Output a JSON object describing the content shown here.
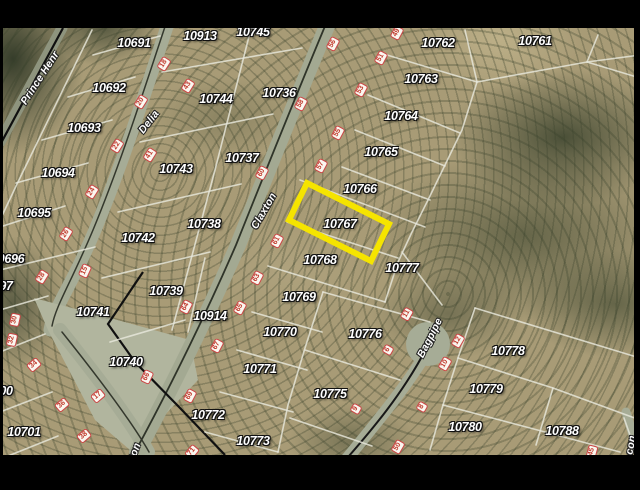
{
  "map": {
    "highlight": {
      "parcel": "10767",
      "color": "#f5e400"
    },
    "marker_color": "#c0392b",
    "road_color": "#a6ac96",
    "parcel_line_color": "#e8e8dc",
    "parcels": [
      {
        "label": "10691",
        "x": 134,
        "y": 43
      },
      {
        "label": "10913",
        "x": 200,
        "y": 36
      },
      {
        "label": "10745",
        "x": 253,
        "y": 32
      },
      {
        "label": "10762",
        "x": 438,
        "y": 43
      },
      {
        "label": "10761",
        "x": 535,
        "y": 41
      },
      {
        "label": "10692",
        "x": 109,
        "y": 88
      },
      {
        "label": "10744",
        "x": 216,
        "y": 99
      },
      {
        "label": "10736",
        "x": 279,
        "y": 93
      },
      {
        "label": "10763",
        "x": 421,
        "y": 79
      },
      {
        "label": "10693",
        "x": 84,
        "y": 128
      },
      {
        "label": "10737",
        "x": 242,
        "y": 158
      },
      {
        "label": "10764",
        "x": 401,
        "y": 116
      },
      {
        "label": "10694",
        "x": 58,
        "y": 173
      },
      {
        "label": "10743",
        "x": 176,
        "y": 169
      },
      {
        "label": "10765",
        "x": 381,
        "y": 152
      },
      {
        "label": "10695",
        "x": 34,
        "y": 213
      },
      {
        "label": "10738",
        "x": 204,
        "y": 224
      },
      {
        "label": "10742",
        "x": 138,
        "y": 238
      },
      {
        "label": "10766",
        "x": 360,
        "y": 189
      },
      {
        "label": "10767",
        "x": 340,
        "y": 224,
        "highlight": true
      },
      {
        "label": "0696",
        "x": 11,
        "y": 259
      },
      {
        "label": "97",
        "x": 6,
        "y": 286
      },
      {
        "label": "10768",
        "x": 320,
        "y": 260
      },
      {
        "label": "10777",
        "x": 402,
        "y": 268
      },
      {
        "label": "10739",
        "x": 166,
        "y": 291
      },
      {
        "label": "10769",
        "x": 299,
        "y": 297
      },
      {
        "label": "10741",
        "x": 93,
        "y": 312
      },
      {
        "label": "10914",
        "x": 210,
        "y": 316
      },
      {
        "label": "10770",
        "x": 280,
        "y": 332
      },
      {
        "label": "10776",
        "x": 365,
        "y": 334
      },
      {
        "label": "10778",
        "x": 508,
        "y": 351
      },
      {
        "label": "10740",
        "x": 126,
        "y": 362
      },
      {
        "label": "10771",
        "x": 260,
        "y": 369
      },
      {
        "label": "10775",
        "x": 330,
        "y": 394
      },
      {
        "label": "00",
        "x": 6,
        "y": 391
      },
      {
        "label": "10779",
        "x": 486,
        "y": 389
      },
      {
        "label": "10772",
        "x": 208,
        "y": 415
      },
      {
        "label": "10780",
        "x": 465,
        "y": 427
      },
      {
        "label": "10788",
        "x": 562,
        "y": 431
      },
      {
        "label": "10701",
        "x": 24,
        "y": 432
      },
      {
        "label": "10773",
        "x": 253,
        "y": 441
      }
    ],
    "streets": [
      {
        "name": "Prince Henr",
        "x": 40,
        "y": 78,
        "rot": -57
      },
      {
        "name": "Delia",
        "x": 149,
        "y": 122,
        "rot": -52
      },
      {
        "name": "Claxton",
        "x": 264,
        "y": 211,
        "rot": -60
      },
      {
        "name": "Claxton",
        "x": 131,
        "y": 462,
        "rot": -70
      },
      {
        "name": "Bagpipe",
        "x": 430,
        "y": 338,
        "rot": -63
      },
      {
        "name": "con",
        "x": 631,
        "y": 445,
        "rot": -80
      }
    ],
    "address_markers": [
      {
        "n": "18",
        "x": 164,
        "y": 64,
        "rot": -58
      },
      {
        "n": "20",
        "x": 141,
        "y": 102,
        "rot": -58
      },
      {
        "n": "22",
        "x": 117,
        "y": 146,
        "rot": -58
      },
      {
        "n": "24",
        "x": 92,
        "y": 192,
        "rot": -58
      },
      {
        "n": "26",
        "x": 66,
        "y": 234,
        "rot": -58
      },
      {
        "n": "28",
        "x": 42,
        "y": 277,
        "rot": -58
      },
      {
        "n": "30",
        "x": 15,
        "y": 320,
        "rot": -78
      },
      {
        "n": "32",
        "x": 12,
        "y": 340,
        "rot": -78
      },
      {
        "n": "34",
        "x": 34,
        "y": 365,
        "rot": -40
      },
      {
        "n": "36",
        "x": 62,
        "y": 405,
        "rot": -40
      },
      {
        "n": "38",
        "x": 84,
        "y": 436,
        "rot": -40
      },
      {
        "n": "43",
        "x": 188,
        "y": 86,
        "rot": -58
      },
      {
        "n": "41",
        "x": 150,
        "y": 155,
        "rot": -58
      },
      {
        "n": "15",
        "x": 85,
        "y": 271,
        "rot": -65
      },
      {
        "n": "17",
        "x": 98,
        "y": 396,
        "rot": -40
      },
      {
        "n": "56",
        "x": 333,
        "y": 44,
        "rot": -62
      },
      {
        "n": "58",
        "x": 301,
        "y": 104,
        "rot": -62
      },
      {
        "n": "60",
        "x": 262,
        "y": 173,
        "rot": -62
      },
      {
        "n": "64",
        "x": 186,
        "y": 307,
        "rot": -62
      },
      {
        "n": "66",
        "x": 147,
        "y": 377,
        "rot": -65
      },
      {
        "n": "49",
        "x": 397,
        "y": 33,
        "rot": -62
      },
      {
        "n": "51",
        "x": 381,
        "y": 58,
        "rot": -62
      },
      {
        "n": "53",
        "x": 361,
        "y": 90,
        "rot": -62
      },
      {
        "n": "55",
        "x": 338,
        "y": 133,
        "rot": -62
      },
      {
        "n": "57",
        "x": 321,
        "y": 166,
        "rot": -62
      },
      {
        "n": "61",
        "x": 277,
        "y": 241,
        "rot": -62
      },
      {
        "n": "63",
        "x": 257,
        "y": 278,
        "rot": -62
      },
      {
        "n": "65",
        "x": 240,
        "y": 308,
        "rot": -62
      },
      {
        "n": "67",
        "x": 217,
        "y": 346,
        "rot": -62
      },
      {
        "n": "69",
        "x": 190,
        "y": 396,
        "rot": -62
      },
      {
        "n": "71",
        "x": 192,
        "y": 452,
        "rot": -50
      },
      {
        "n": "11",
        "x": 407,
        "y": 314,
        "rot": -60
      },
      {
        "n": "12",
        "x": 458,
        "y": 341,
        "rot": -60
      },
      {
        "n": "10",
        "x": 445,
        "y": 364,
        "rot": -60
      },
      {
        "n": "8",
        "x": 422,
        "y": 407,
        "rot": -60
      },
      {
        "n": "6",
        "x": 388,
        "y": 350,
        "rot": -60
      },
      {
        "n": "9",
        "x": 356,
        "y": 409,
        "rot": -60
      },
      {
        "n": "50",
        "x": 398,
        "y": 447,
        "rot": -60
      },
      {
        "n": "45",
        "x": 592,
        "y": 452,
        "rot": -75
      }
    ]
  }
}
